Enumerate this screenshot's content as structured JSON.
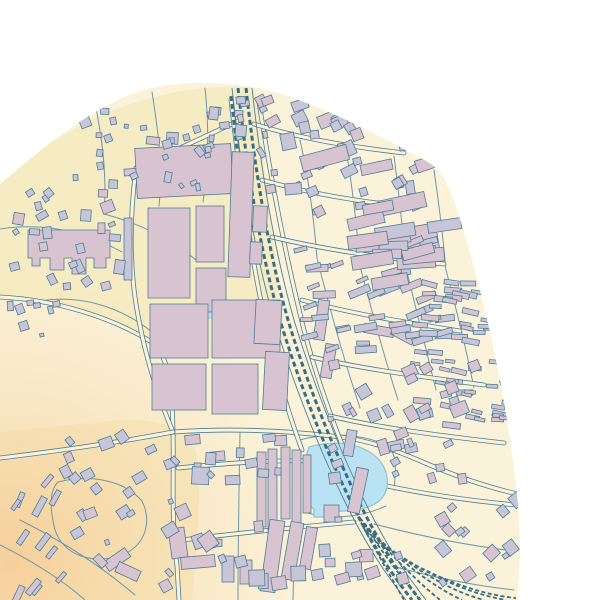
{
  "map": {
    "viewport": {
      "width": 600,
      "height": 600
    },
    "colors": {
      "outside": "#ffffff",
      "base": "#faf3d9",
      "residential": "#f6ecc4",
      "building_pink": "#d7c4d0",
      "building_lavender": "#c8c5d9",
      "outline": "#4d7d96",
      "road_minor": "#6e97ab",
      "rail": "#3a6d84",
      "water_fill": "#b9e3f3",
      "water_stroke": "#8fc3d6"
    },
    "vignette": {
      "cx": 10,
      "cy": 560,
      "r": 400,
      "stops": [
        [
          "0",
          "rgba(246,184,120,0.55)"
        ],
        [
          "0.45",
          "rgba(247,205,150,0.28)"
        ],
        [
          "0.75",
          "rgba(247,205,150,0)"
        ]
      ]
    },
    "boundary_path": "M 0 184 C 38 152 78 118 124 97 C 162 81 206 80 252 87 C 306 96 380 136 426 161 C 446 172 452 193 464 232 C 479 282 494 345 504 402 C 512 450 519 497 520 543 C 520 563 519 583 517 600 L 0 600 Z",
    "landuse": [
      "M 0 180 C 70 120 160 80 255 88 L 285 340 C 230 360 180 368 150 342 C 118 318 60 302 0 298 Z",
      "M 0 432 L 120 420 C 160 418 186 428 196 452 C 202 480 198 540 192 600 L 0 600 Z"
    ],
    "water": {
      "ponds": [
        "M 309 447 C 330 441 352 442 368 451 C 382 459 389 472 387 487 C 385 499 376 506 360 509 C 348 511 336 512 326 511 L 326 517 L 314 517 L 314 509 C 307 505 304 497 304 487 C 303 473 305 458 309 447 Z"
      ],
      "rects": [
        [
          197,
          305,
          18,
          13
        ]
      ]
    },
    "roads": {
      "main": [
        "M 0 297 C 58 300 112 318 150 341 C 168 353 172 382 173 432 C 174 472 171 522 177 566 L 179 600",
        "M 173 432 C 232 428 292 431 341 437 C 372 441 400 452 425 463 C 458 477 490 488 518 494",
        "M 136 168 C 129 222 129 272 139 321 C 145 352 156 392 173 432",
        "M 136 168 C 172 152 204 137 238 121",
        "M 231 100 C 240 180 251 258 267 330 C 278 378 290 418 302 450",
        "M 259 102 C 271 180 286 258 304 330 C 318 383 338 438 358 482",
        "M 254 124 C 302 139 352 147 404 153",
        "M 262 180 C 312 194 364 203 418 207",
        "M 272 237 C 322 249 382 258 444 264",
        "M 302 300 C 352 314 404 322 460 331",
        "M 312 357 C 362 369 424 377 484 385",
        "M 330 416 C 380 428 442 436 504 443",
        "M 360 480 C 410 492 462 500 516 505",
        "M 178 468 C 238 462 298 458 352 463",
        "M 182 540 C 240 533 298 527 354 522",
        "M 0 458 C 50 452 110 444 173 432"
      ],
      "minor": [
        "M 95 103 C 103 142 107 178 104 214",
        "M 152 92 C 158 130 163 166 159 206",
        "M 205 88 C 209 126 209 162 203 202",
        "M 0 229 C 45 222 86 232 122 252",
        "M 40 301 C 82 294 122 308 152 332",
        "M 104 214 C 142 224 172 240 196 260",
        "M 300 140 C 309 180 314 220 317 258",
        "M 346 150 C 353 190 357 228 360 266",
        "M 394 156 C 399 194 403 232 406 268",
        "M 434 170 C 439 204 443 238 446 270",
        "M 317 258 C 330 310 344 360 360 408",
        "M 360 266 C 372 312 384 356 398 400",
        "M 406 268 C 416 308 426 348 436 390",
        "M 446 270 C 456 308 466 348 474 388",
        "M 374 524 C 424 537 472 546 514 551",
        "M 392 566 C 436 578 478 586 514 590",
        "M 240 432 C 239 488 238 544 238 600",
        "M 298 459 C 296 506 294 553 293 600",
        "M 58 482 C 90 474 124 480 142 501 C 152 522 146 546 120 556 C 92 564 64 556 55 530 C 49 506 50 490 58 482",
        "M 20 520 C 60 540 100 565 135 595",
        "M 0 545 C 30 560 60 578 85 600",
        "M 300 440 C 330 432 360 434 384 444 C 398 450 396 470 394 490",
        "M 304 512 C 330 520 360 518 386 506"
      ]
    },
    "railway": {
      "tracks": [
        "M 238 88 C 247 170 260 250 280 320 C 298 380 325 450 355 510 C 378 555 395 578 412 600",
        "M 246 88 C 255 170 268 250 288 320 C 306 380 333 450 363 510 C 386 555 403 578 420 600",
        "M 231 96 C 237 150 243 205 251 256"
      ],
      "edges": [
        "M 232 88 C 241 170 254 250 274 320 C 292 380 319 450 349 510 C 372 555 389 578 406 600",
        "M 252 88 C 261 170 274 250 294 320 C 312 380 339 450 369 510 C 392 555 409 578 426 600"
      ],
      "yard": [
        "M 352 505 C 372 545 390 575 404 600",
        "M 356 512 C 380 550 402 578 420 600",
        "M 360 518 C 390 555 418 582 440 600",
        "M 364 524 C 398 560 432 586 462 600",
        "M 368 530 C 406 564 446 590 484 600",
        "M 372 536 C 414 568 460 592 506 600",
        "M 376 542 C 422 572 472 594 516 598"
      ]
    },
    "buildings": {
      "fixed": [
        [
          136,
          146,
          96,
          50,
          -3,
          "p"
        ],
        [
          230,
          152,
          22,
          125,
          2,
          "p"
        ],
        [
          148,
          208,
          42,
          90,
          0,
          "p"
        ],
        [
          196,
          206,
          28,
          56,
          0,
          "p"
        ],
        [
          196,
          268,
          30,
          44,
          0,
          "p"
        ],
        [
          150,
          304,
          58,
          54,
          0,
          "p"
        ],
        [
          152,
          364,
          54,
          46,
          0,
          "p"
        ],
        [
          212,
          300,
          68,
          58,
          0,
          "p"
        ],
        [
          212,
          364,
          46,
          50,
          0,
          "p"
        ],
        [
          264,
          352,
          24,
          58,
          3,
          "p"
        ],
        [
          255,
          300,
          26,
          44,
          3,
          "p"
        ],
        [
          253,
          206,
          14,
          26,
          2,
          "p"
        ],
        [
          250,
          242,
          12,
          22,
          2,
          "p"
        ],
        [
          124,
          218,
          8,
          62,
          0,
          "l"
        ],
        [
          257,
          452,
          9,
          75,
          0,
          "p"
        ],
        [
          268,
          449,
          9,
          85,
          0,
          "p"
        ],
        [
          281,
          447,
          9,
          72,
          0,
          "p"
        ],
        [
          292,
          450,
          9,
          92,
          0,
          "p"
        ],
        [
          303,
          455,
          8,
          58,
          0,
          "p"
        ],
        [
          324,
          505,
          15,
          17,
          0,
          "p"
        ],
        [
          316,
          300,
          11,
          40,
          8,
          "p"
        ],
        [
          323,
          344,
          11,
          34,
          10,
          "p"
        ],
        [
          364,
          326,
          30,
          9,
          10,
          "p"
        ],
        [
          391,
          331,
          24,
          9,
          28,
          "p"
        ],
        [
          398,
          226,
          40,
          30,
          -10,
          "p"
        ],
        [
          265,
          520,
          15,
          72,
          8,
          "p"
        ],
        [
          286,
          522,
          13,
          58,
          10,
          "p"
        ],
        [
          303,
          527,
          11,
          42,
          10,
          "p"
        ],
        [
          170,
          528,
          16,
          30,
          -8,
          "p"
        ],
        [
          181,
          556,
          34,
          12,
          -5,
          "p"
        ],
        [
          222,
          556,
          12,
          26,
          0,
          "l"
        ],
        [
          240,
          560,
          12,
          24,
          0,
          "p"
        ],
        [
          104,
          554,
          26,
          11,
          -35,
          "p"
        ],
        [
          116,
          566,
          24,
          11,
          25,
          "p"
        ],
        [
          318,
          112,
          26,
          13,
          -22,
          "p"
        ],
        [
          292,
          100,
          16,
          10,
          -20,
          "l"
        ],
        [
          352,
          468,
          12,
          45,
          12,
          "p"
        ],
        [
          345,
          430,
          10,
          26,
          10,
          "l"
        ]
      ],
      "shapes": [
        "M 28 230 H 110 V 258 H 106 V 268 H 94 V 258 H 86 V 274 H 72 V 258 H 64 V 270 H 50 V 258 H 40 V 266 H 32 V 258 H 28 Z"
      ],
      "clusters": [
        {
          "x": 8,
          "y": 188,
          "w": 118,
          "h": 112,
          "n": 26,
          "smin": 4,
          "smax": 10,
          "ang": -15,
          "spread": 25,
          "pink": 0.25,
          "elong": false,
          "seed": 11
        },
        {
          "x": 58,
          "y": 108,
          "w": 155,
          "h": 86,
          "n": 22,
          "smin": 4,
          "smax": 9,
          "ang": -15,
          "spread": 25,
          "pink": 0.2,
          "elong": false,
          "seed": 22
        },
        {
          "x": 158,
          "y": 94,
          "w": 92,
          "h": 56,
          "n": 10,
          "smin": 4,
          "smax": 8,
          "ang": -10,
          "spread": 20,
          "pink": 0.2,
          "elong": false,
          "seed": 33
        },
        {
          "x": 0,
          "y": 300,
          "w": 62,
          "h": 44,
          "n": 8,
          "smin": 4,
          "smax": 9,
          "ang": -20,
          "spread": 20,
          "pink": 0.3,
          "elong": false,
          "seed": 44
        },
        {
          "x": 205,
          "y": 96,
          "w": 42,
          "h": 62,
          "n": 8,
          "smin": 4,
          "smax": 8,
          "ang": -5,
          "spread": 15,
          "pink": 0.3,
          "elong": false,
          "seed": 55
        },
        {
          "x": 256,
          "y": 92,
          "w": 170,
          "h": 125,
          "n": 48,
          "smin": 5,
          "smax": 11,
          "ang": -18,
          "spread": 14,
          "pink": 0.45,
          "elong": false,
          "seed": 66
        },
        {
          "x": 282,
          "y": 238,
          "w": 185,
          "h": 118,
          "n": 42,
          "smin": 5,
          "smax": 10,
          "ang": -12,
          "spread": 12,
          "pink": 0.5,
          "elong": true,
          "seed": 77
        },
        {
          "x": 410,
          "y": 268,
          "w": 118,
          "h": 165,
          "n": 60,
          "smin": 4,
          "smax": 8,
          "ang": 8,
          "spread": 8,
          "pink": 0.5,
          "elong": true,
          "seed": 88
        },
        {
          "x": 325,
          "y": 360,
          "w": 160,
          "h": 125,
          "n": 34,
          "smin": 5,
          "smax": 11,
          "ang": -20,
          "spread": 12,
          "pink": 0.45,
          "elong": false,
          "seed": 99
        },
        {
          "x": 436,
          "y": 492,
          "w": 88,
          "h": 100,
          "n": 14,
          "smin": 5,
          "smax": 12,
          "ang": -35,
          "spread": 10,
          "pink": 0.5,
          "elong": false,
          "seed": 101
        },
        {
          "x": 182,
          "y": 434,
          "w": 125,
          "h": 62,
          "n": 12,
          "smin": 6,
          "smax": 12,
          "ang": -4,
          "spread": 8,
          "pink": 0.4,
          "elong": false,
          "seed": 112
        },
        {
          "x": 196,
          "y": 516,
          "w": 150,
          "h": 76,
          "n": 12,
          "smin": 6,
          "smax": 12,
          "ang": -6,
          "spread": 8,
          "pink": 0.4,
          "elong": false,
          "seed": 123
        },
        {
          "x": 52,
          "y": 428,
          "w": 178,
          "h": 170,
          "n": 30,
          "smin": 5,
          "smax": 11,
          "ang": -32,
          "spread": 14,
          "pink": 0.35,
          "elong": false,
          "seed": 134
        },
        {
          "x": 8,
          "y": 478,
          "w": 66,
          "h": 122,
          "n": 12,
          "smin": 5,
          "smax": 9,
          "ang": -58,
          "spread": 10,
          "pink": 0.3,
          "elong": true,
          "seed": 145
        },
        {
          "x": 330,
          "y": 540,
          "w": 92,
          "h": 58,
          "n": 8,
          "smin": 6,
          "smax": 12,
          "ang": -10,
          "spread": 10,
          "pink": 0.5,
          "elong": false,
          "seed": 156
        },
        {
          "x": 300,
          "y": 150,
          "w": 180,
          "h": 110,
          "n": 10,
          "smin": 13,
          "smax": 22,
          "ang": -12,
          "spread": 10,
          "pink": 0.7,
          "elong": true,
          "seed": 167
        },
        {
          "x": 345,
          "y": 228,
          "w": 120,
          "h": 60,
          "n": 8,
          "smin": 12,
          "smax": 20,
          "ang": -8,
          "spread": 8,
          "pink": 0.7,
          "elong": true,
          "seed": 178
        }
      ]
    }
  }
}
